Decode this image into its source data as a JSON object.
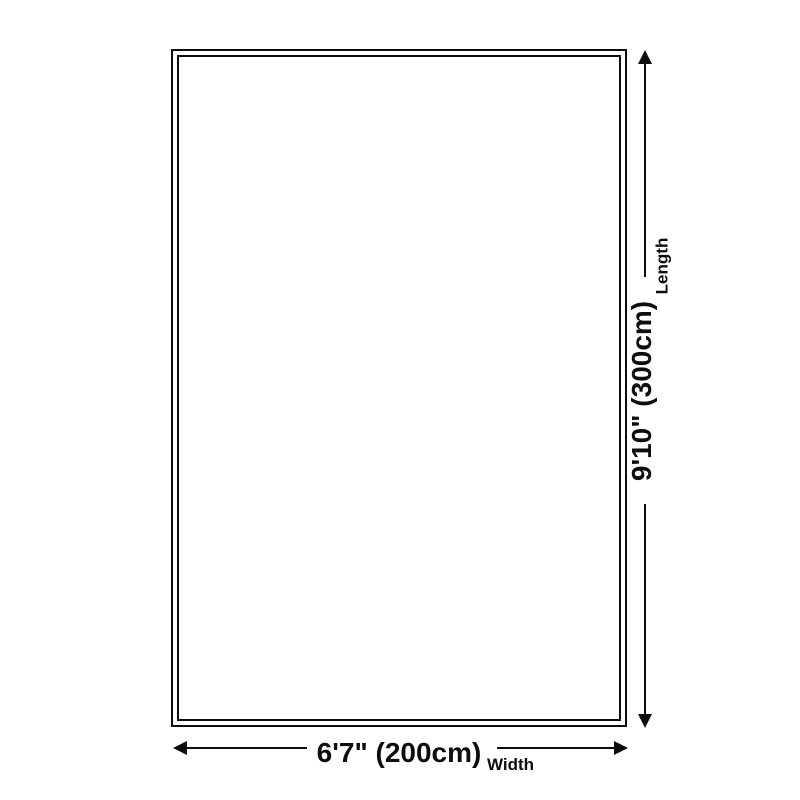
{
  "diagram": {
    "type": "product-dimensions",
    "shape": "rectangle",
    "width": {
      "value": "6'7\" (200cm)",
      "label": "Width"
    },
    "length": {
      "value": "9'10\" (300cm)",
      "label": "Length"
    }
  },
  "colors": {
    "line": "#0d0d0d",
    "text": "#0d0d0d",
    "background": "#ffffff"
  }
}
